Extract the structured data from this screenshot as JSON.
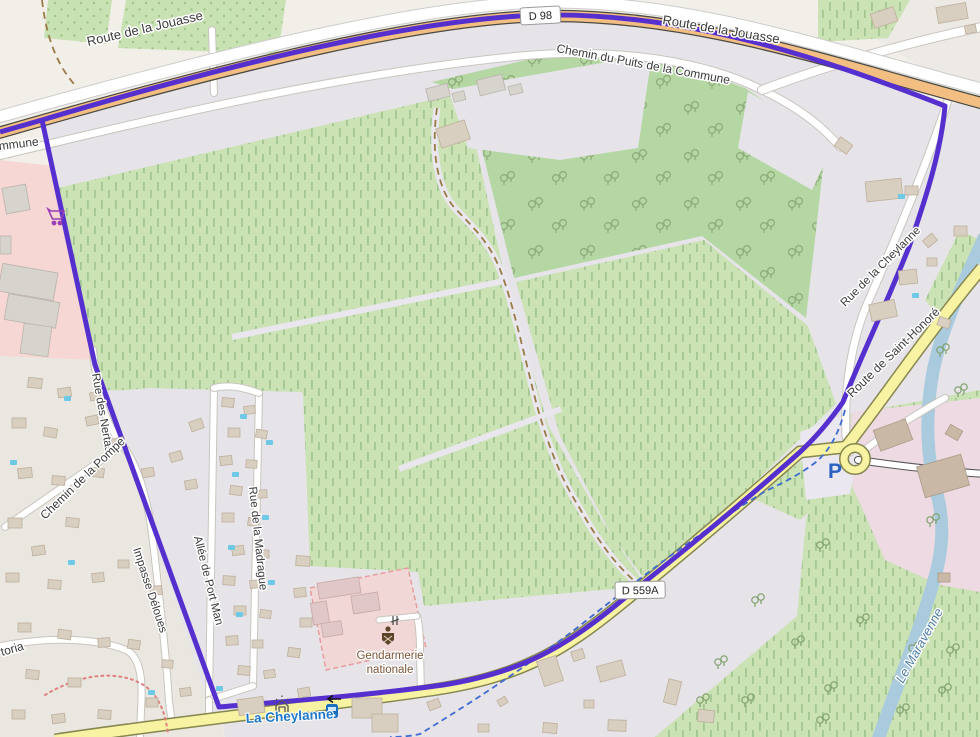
{
  "map": {
    "labels": {
      "route_jouasse_left": "Route de la Jouasse",
      "route_jouasse_right": "Route de la Jouasse",
      "chemin_puits": "Chemin du Puits de la Commune",
      "commune_partial": "Commune",
      "rue_des_nertas": "Rue des Nertas",
      "chemin_pompe": "Chemin de la Pompe",
      "impasse_deloues": "Impasse Déloues",
      "toria_partial": "toria",
      "allee_port_man": "Allée de Port Man",
      "rue_madrague": "Rue de la Madrague",
      "gendarmerie_line1": "Gendarmerie",
      "gendarmerie_line2": "nationale",
      "la_cheylanne": "La Cheylanne",
      "route_st_honore": "Route de Saint-Honoré",
      "rue_cheylanne": "Rue de la Cheylanne",
      "le_maravenne": "Le Maravenne",
      "parking": "P"
    },
    "shields": {
      "d98": "D 98",
      "d559a": "D 559A"
    },
    "icons": {
      "supermarket": "supermarket-cart-icon",
      "bus_stop": "bus-stop-icon",
      "one_way": "one-way-arrow-icon",
      "gate": "gate-icon",
      "barrier": "barrier-icon",
      "gendarmerie": "gendarmerie-badge-icon"
    },
    "colors": {
      "boundary": "#5630CE",
      "primary_road": "#F3BE82",
      "secondary_road": "#F7F3A2",
      "water": "#A9CBDD",
      "vineyard": "#CBE2B4",
      "orchard": "#B5D7A3",
      "retail_area": "#F7D7D3",
      "school_area": "#EDDAE3",
      "military_area": "#F1D8D7",
      "stream": "#3E6BD0",
      "water_label": "#4E7FA6",
      "stream_label": "#1E78C8",
      "poi_label": "#7A5539",
      "parking_label": "#2A62C4"
    }
  }
}
